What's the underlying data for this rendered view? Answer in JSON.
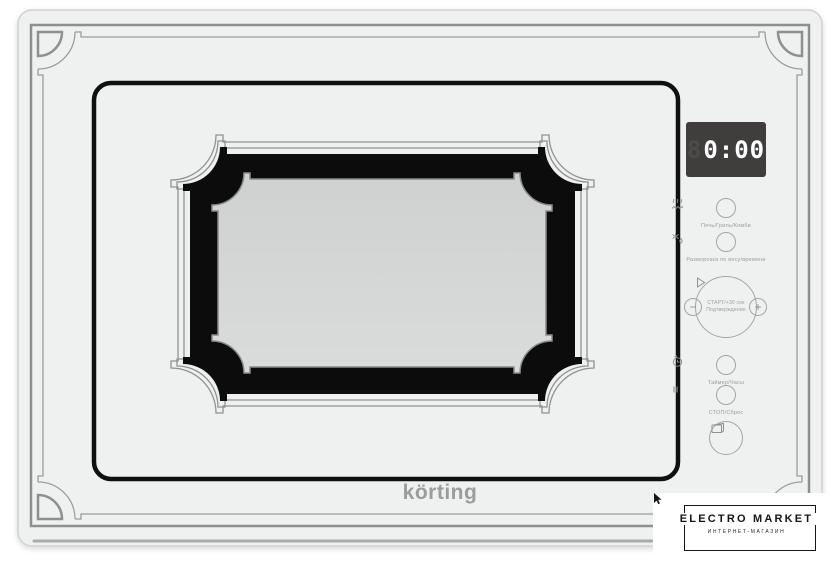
{
  "product": {
    "brand_logo": "körting",
    "display": {
      "time": "0:00",
      "ghost_digit": "8"
    },
    "controls": {
      "mode": {
        "label": "Печь/Гриль/Комби",
        "icon": "microwave-grill-combi-icon"
      },
      "defrost": {
        "label": "Разморозка по весу/времени",
        "icon": "defrost-icon"
      },
      "start": {
        "label_line1": "СТАРТ/+30 сек",
        "label_line2": "Подтверждение",
        "icon": "play-icon"
      },
      "minus": {
        "symbol": "−"
      },
      "plus": {
        "symbol": "+"
      },
      "timer": {
        "label": "Таймер/Часы",
        "icon": "timer-clock-icon"
      },
      "stop": {
        "label": "СТОП/Сброс",
        "icon": "pause-icon"
      },
      "door_open": {
        "icon": "door-open-icon"
      }
    }
  },
  "watermark": {
    "title": "ELECTRO MARKET",
    "subtitle": "ИНТЕРНЕТ-МАГАЗИН"
  },
  "colors": {
    "body": "#eff1f0",
    "ornament": "#8e9090",
    "window_black": "#0c0c0c",
    "glass": "#d7d9d8",
    "display_bg": "#403d3d",
    "display_digits": "#ffffff",
    "control_gray": "#9b9d9d",
    "watermark_ink": "#151515"
  }
}
